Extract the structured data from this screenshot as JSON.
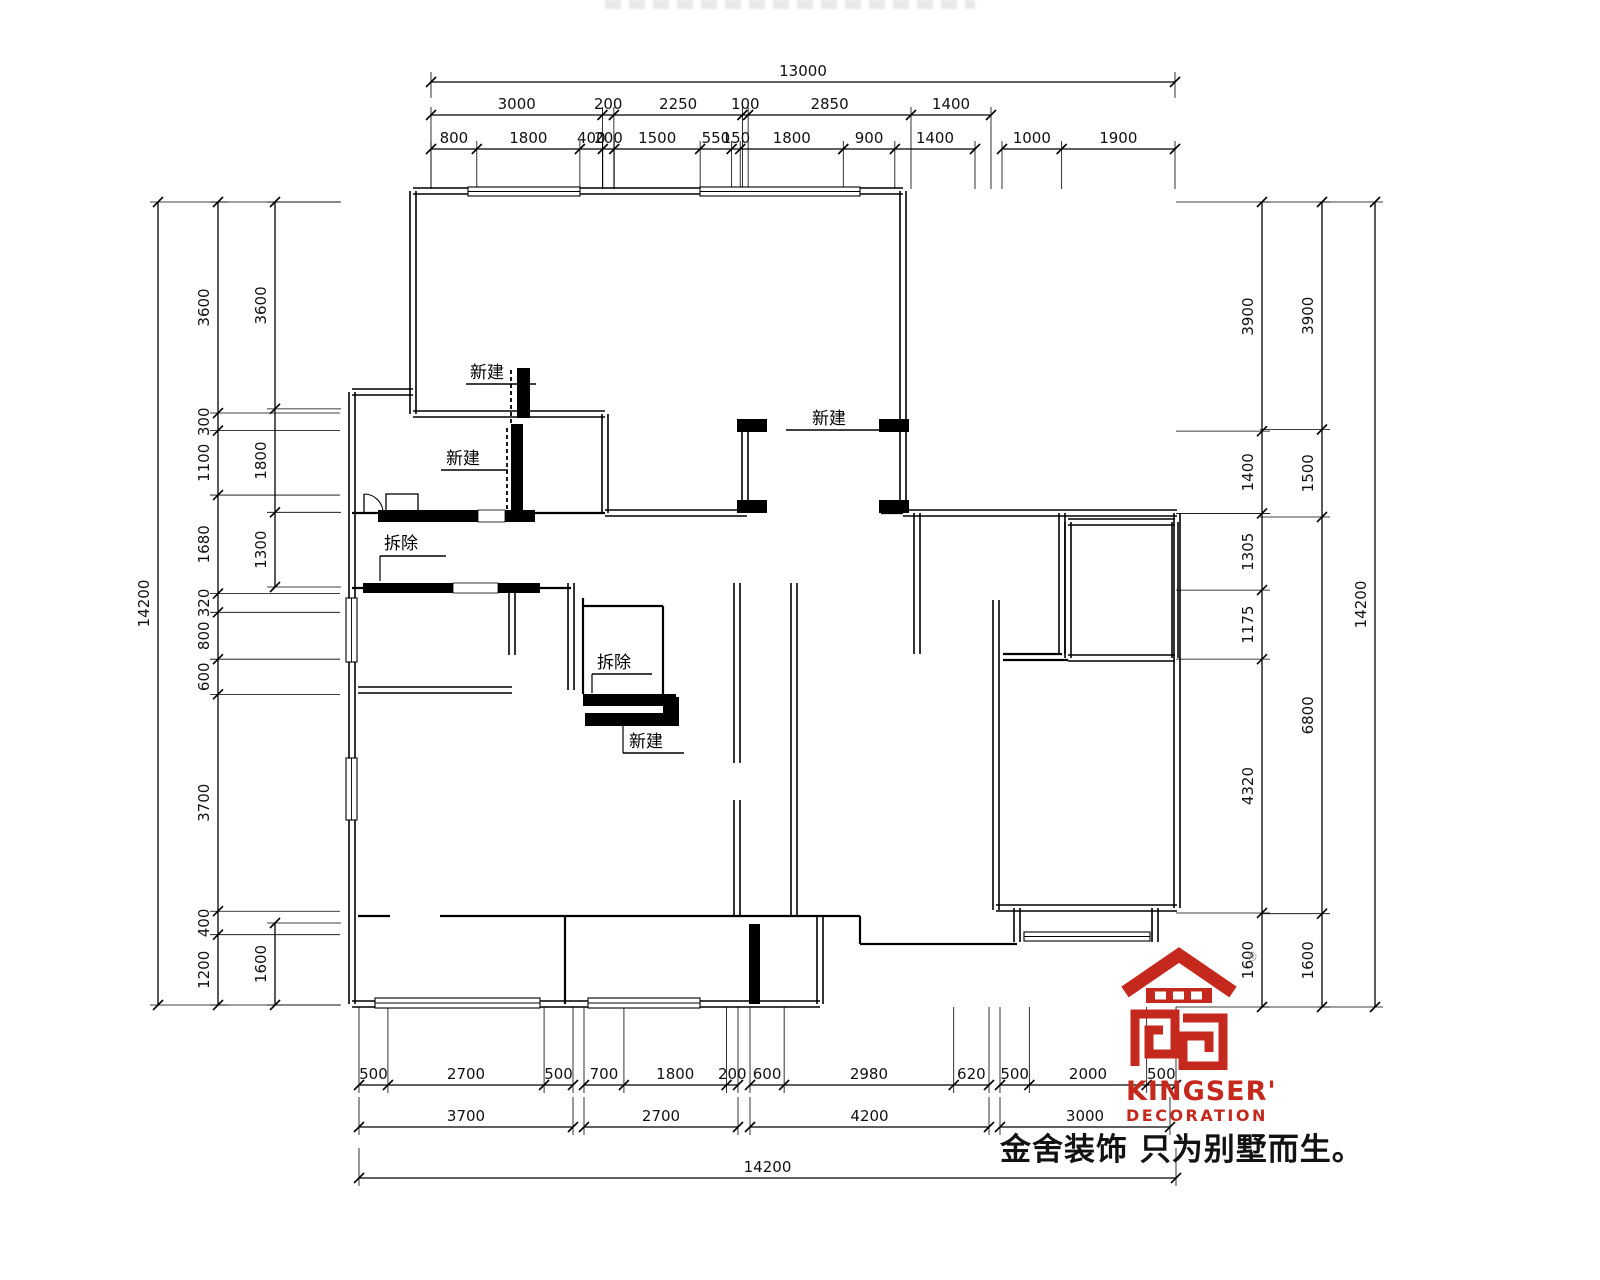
{
  "page": {
    "width": 1600,
    "height": 1280,
    "background": "#ffffff",
    "line_color": "#000000",
    "accent_red": "#c5281c"
  },
  "logo": {
    "brand": "KINGSER'",
    "sub": "DECORATION",
    "reg": "®",
    "tagline": "金舍装饰 只为别墅而生。",
    "color": "#c5281c"
  },
  "annotations": [
    {
      "text": "新建",
      "x": 470,
      "y": 378,
      "ul": [
        466,
        384,
        536,
        384
      ],
      "leader": []
    },
    {
      "text": "新建",
      "x": 446,
      "y": 464,
      "ul": [
        441,
        470,
        508,
        470
      ],
      "leader": []
    },
    {
      "text": "拆除",
      "x": 384,
      "y": 549,
      "ul": [
        380,
        556,
        446,
        556
      ],
      "leader": [
        [
          380,
          556
        ],
        [
          380,
          581
        ]
      ]
    },
    {
      "text": "新建",
      "x": 812,
      "y": 424,
      "ul": [
        786,
        430,
        879,
        430
      ],
      "leader": []
    },
    {
      "text": "拆除",
      "x": 597,
      "y": 668,
      "ul": [
        592,
        674,
        652,
        674
      ],
      "leader": [
        [
          592,
          674
        ],
        [
          592,
          693
        ]
      ]
    },
    {
      "text": "新建",
      "x": 629,
      "y": 747,
      "ul": [
        623,
        753,
        684,
        753
      ],
      "leader": [
        [
          623,
          753
        ],
        [
          623,
          726
        ]
      ]
    }
  ],
  "chart_data": {
    "type": "floor-plan-dimensions",
    "dimension_chains": [
      {
        "name": "top-total",
        "side": "top",
        "line": 82,
        "start": 431,
        "end": 1175,
        "values": [
          "13000"
        ],
        "wit": [
          -10,
          16
        ]
      },
      {
        "name": "top-row2",
        "side": "top",
        "line": 115,
        "start": 431,
        "end": 991,
        "values": [
          "3000",
          "200",
          "2250",
          "100",
          "2850",
          "1400"
        ],
        "wit": [
          -8,
          74
        ]
      },
      {
        "name": "top-row3",
        "side": "top",
        "line": 149,
        "start": 431,
        "end": 975,
        "values": [
          "800",
          "1800",
          "400",
          "200",
          "1500",
          "550",
          "150",
          "1800",
          "900",
          "1400"
        ],
        "wit": [
          -8,
          40
        ]
      },
      {
        "name": "top-row3b",
        "side": "top",
        "line": 149,
        "start": 1002,
        "end": 1175,
        "values": [
          "1000",
          "1900"
        ],
        "wit": [
          -8,
          40
        ]
      },
      {
        "name": "left-total",
        "side": "left",
        "line": 158,
        "start": 202,
        "end": 1005,
        "values": [
          "14200"
        ],
        "wit": [
          -8,
          70
        ]
      },
      {
        "name": "left-mid",
        "side": "left",
        "line": 218,
        "start": 202,
        "end": 1005,
        "values": [
          "3600",
          "300",
          "1100",
          "1680",
          "320",
          "800",
          "600",
          "3700",
          "400",
          "1200"
        ],
        "wit": [
          -8,
          122
        ]
      },
      {
        "name": "left-inner-a",
        "side": "left",
        "line": 275,
        "start": 202,
        "end": 587,
        "values": [
          "3600",
          "1800",
          "1300"
        ],
        "wit": [
          -8,
          66
        ]
      },
      {
        "name": "left-inner-b",
        "side": "left",
        "line": 275,
        "start": 923,
        "end": 1005,
        "values": [
          "1600"
        ],
        "wit": [
          -8,
          66
        ]
      },
      {
        "name": "right-inner",
        "side": "right",
        "line": 1262,
        "start": 202,
        "end": 1007,
        "values": [
          "3900",
          "1400",
          "1305",
          "1175",
          "4320",
          "1600"
        ],
        "wit": [
          -86,
          8
        ]
      },
      {
        "name": "right-mid",
        "side": "right",
        "line": 1322,
        "start": 202,
        "end": 1007,
        "values": [
          "3900",
          "1500",
          "6800",
          "1600"
        ],
        "wit": [
          -62,
          8
        ]
      },
      {
        "name": "right-total",
        "side": "right",
        "line": 1375,
        "start": 202,
        "end": 1007,
        "values": [
          "14200"
        ],
        "wit": [
          -56,
          8
        ]
      },
      {
        "name": "bot-r1a",
        "side": "bottom",
        "line": 1085,
        "start": 359,
        "end": 573,
        "values": [
          "500",
          "2700",
          "500"
        ],
        "wit": [
          -78,
          8
        ]
      },
      {
        "name": "bot-r1b",
        "side": "bottom",
        "line": 1085,
        "start": 584,
        "end": 738,
        "values": [
          "700",
          "1800",
          "200"
        ],
        "wit": [
          -78,
          8
        ]
      },
      {
        "name": "bot-r1c",
        "side": "bottom",
        "line": 1085,
        "start": 750,
        "end": 989,
        "values": [
          "600",
          "2980",
          "620"
        ],
        "wit": [
          -78,
          8
        ]
      },
      {
        "name": "bot-r1d",
        "side": "bottom",
        "line": 1085,
        "start": 1000,
        "end": 1176,
        "values": [
          "500",
          "2000",
          "500"
        ],
        "wit": [
          -78,
          8
        ]
      },
      {
        "name": "bot-r2a",
        "side": "bottom",
        "line": 1127,
        "start": 359,
        "end": 573,
        "values": [
          "3700"
        ],
        "wit": [
          -30,
          8
        ]
      },
      {
        "name": "bot-r2b",
        "side": "bottom",
        "line": 1127,
        "start": 584,
        "end": 738,
        "values": [
          "2700"
        ],
        "wit": [
          -30,
          8
        ]
      },
      {
        "name": "bot-r2c",
        "side": "bottom",
        "line": 1127,
        "start": 750,
        "end": 989,
        "values": [
          "4200"
        ],
        "wit": [
          -30,
          8
        ]
      },
      {
        "name": "bot-r2d",
        "side": "bottom",
        "line": 1127,
        "start": 1000,
        "end": 1170,
        "values": [
          "3000"
        ],
        "wit": [
          -30,
          8
        ]
      },
      {
        "name": "bot-total",
        "side": "bottom",
        "line": 1178,
        "start": 359,
        "end": 1176,
        "values": [
          "14200"
        ],
        "wit": [
          -30,
          8
        ]
      }
    ]
  },
  "floor_plan": {
    "walls": [
      [
        413,
        191,
        600,
        191,
        "d"
      ],
      [
        600,
        191,
        903,
        191,
        "d"
      ],
      [
        903,
        191,
        903,
        513,
        "d"
      ],
      [
        903,
        513,
        1177,
        513,
        "d"
      ],
      [
        1177,
        513,
        1177,
        908,
        "d"
      ],
      [
        352,
        392,
        413,
        392,
        "d"
      ],
      [
        413,
        191,
        413,
        414,
        "d"
      ],
      [
        352,
        392,
        352,
        1004,
        "d"
      ],
      [
        352,
        1004,
        820,
        1004,
        "d"
      ],
      [
        820,
        916,
        820,
        1004,
        "d"
      ],
      [
        358,
        916,
        390,
        916,
        "s"
      ],
      [
        440,
        916,
        860,
        916,
        "s"
      ],
      [
        860,
        916,
        860,
        944,
        "s"
      ],
      [
        860,
        944,
        1017,
        944,
        "s"
      ],
      [
        1017,
        908,
        1017,
        942,
        "d"
      ],
      [
        1155,
        908,
        1155,
        942,
        "d"
      ],
      [
        996,
        908,
        1177,
        908,
        "d"
      ],
      [
        413,
        414,
        605,
        414,
        "d"
      ],
      [
        605,
        414,
        605,
        513,
        "d"
      ],
      [
        605,
        513,
        747,
        513,
        "d"
      ],
      [
        745,
        425,
        745,
        513,
        "d"
      ],
      [
        881,
        513,
        903,
        513,
        "s"
      ],
      [
        352,
        513,
        378,
        513,
        "s"
      ],
      [
        535,
        513,
        605,
        513,
        "s"
      ],
      [
        352,
        588,
        363,
        588,
        "s"
      ],
      [
        512,
        588,
        571,
        588,
        "s"
      ],
      [
        358,
        690,
        512,
        690,
        "d"
      ],
      [
        512,
        593,
        512,
        655,
        "d"
      ],
      [
        571,
        583,
        571,
        690,
        "d"
      ],
      [
        737,
        583,
        737,
        763,
        "d"
      ],
      [
        737,
        800,
        737,
        916,
        "d"
      ],
      [
        794,
        583,
        794,
        916,
        "d"
      ],
      [
        996,
        600,
        996,
        910,
        "d"
      ],
      [
        917,
        513,
        917,
        654,
        "d"
      ],
      [
        1003,
        654,
        1062,
        654,
        "s"
      ],
      [
        1062,
        513,
        1062,
        654,
        "d"
      ],
      [
        1068,
        522,
        1175,
        522,
        "d"
      ],
      [
        1068,
        522,
        1068,
        658,
        "d"
      ],
      [
        1175,
        522,
        1175,
        658,
        "d"
      ],
      [
        1068,
        658,
        1175,
        658,
        "d"
      ],
      [
        1003,
        660,
        1068,
        660,
        "s"
      ],
      [
        583,
        598,
        583,
        694,
        "s"
      ],
      [
        583,
        606,
        663,
        606,
        "s"
      ],
      [
        663,
        606,
        663,
        697,
        "s"
      ],
      [
        565,
        916,
        565,
        1004,
        "s"
      ]
    ],
    "new_walls": [
      [
        517,
        368,
        13,
        50
      ],
      [
        511,
        424,
        12,
        88
      ],
      [
        378,
        510,
        100,
        12
      ],
      [
        505,
        510,
        30,
        12
      ],
      [
        363,
        583,
        90,
        10
      ],
      [
        498,
        583,
        42,
        10
      ],
      [
        583,
        694,
        93,
        12
      ],
      [
        585,
        713,
        94,
        13
      ],
      [
        663,
        697,
        16,
        29
      ],
      [
        737,
        419,
        30,
        13
      ],
      [
        879,
        419,
        30,
        13
      ],
      [
        737,
        500,
        30,
        13
      ],
      [
        879,
        500,
        30,
        13
      ],
      [
        749,
        924,
        11,
        80
      ]
    ],
    "gap_boxes": [
      [
        453,
        583,
        45,
        10
      ],
      [
        478,
        510,
        27,
        12
      ]
    ],
    "dashed_walls": [
      [
        511,
        370,
        511,
        424
      ],
      [
        507,
        428,
        507,
        510
      ]
    ],
    "windows": [
      [
        468,
        187,
        112,
        9
      ],
      [
        700,
        187,
        160,
        9
      ],
      [
        346,
        598,
        11,
        64
      ],
      [
        346,
        758,
        11,
        62
      ],
      [
        375,
        998,
        165,
        10
      ],
      [
        588,
        998,
        112,
        10
      ],
      [
        1024,
        932,
        126,
        9
      ]
    ],
    "furniture": [
      [
        386,
        494,
        32,
        18
      ]
    ],
    "doors": [
      {
        "leaf": [
          364,
          513,
          364,
          494
        ],
        "arc": "M 364 494 A 19 19 0 0 1 383 513"
      }
    ]
  }
}
